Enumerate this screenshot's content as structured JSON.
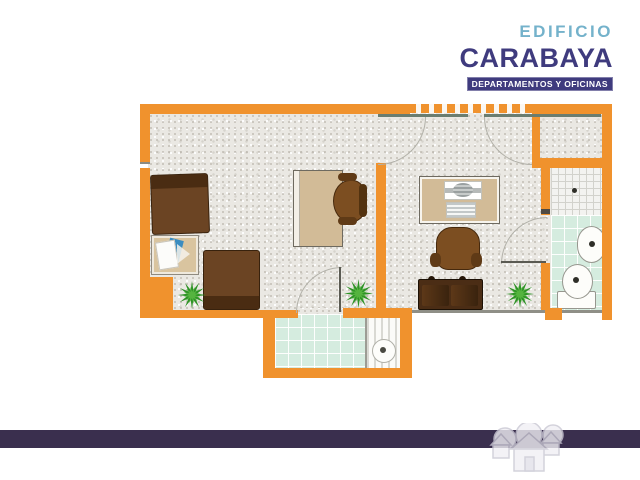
{
  "header": {
    "line1": "EDIFICIO",
    "line2": "CARABAYA",
    "banner": "DEPARTAMENTOS Y OFICINAS"
  },
  "palette": {
    "wall_orange": "#f0922d",
    "floor_gray": "#eae8e3",
    "tile_mint": "#d5ecdf",
    "desk_tan": "#d2bb97",
    "furniture_brown": "#6b4423",
    "plant_green": "#2e9326",
    "teal": "#74b2cb",
    "navy": "#3f3b7e",
    "footer_purple": "#3a2f4e"
  },
  "icons": {
    "plant": "green-starburst-shrub",
    "houses_watermark": "faint-house-cluster"
  }
}
